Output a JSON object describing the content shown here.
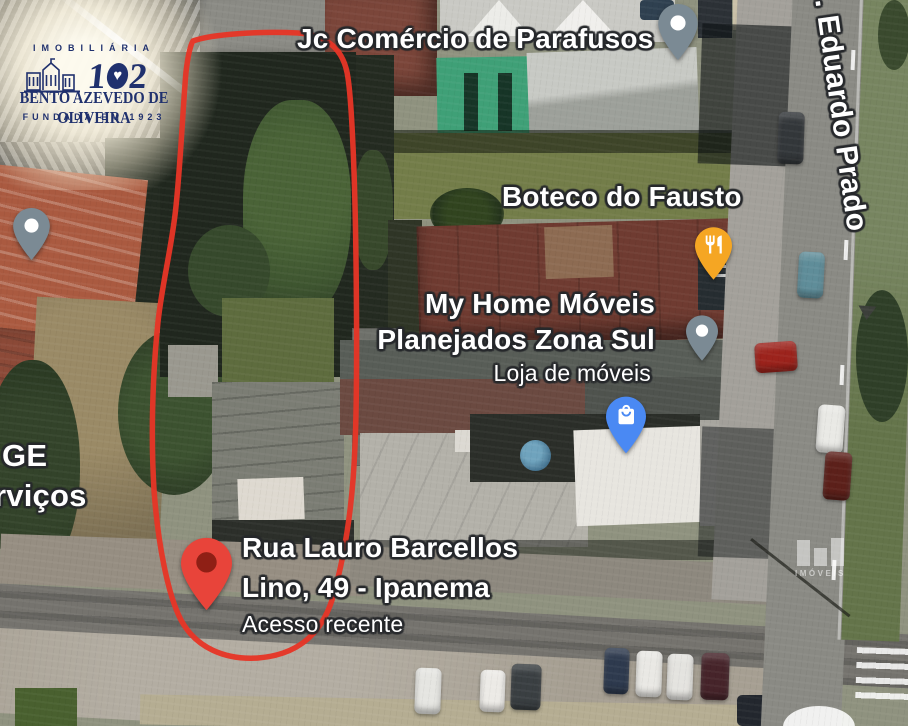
{
  "map": {
    "poi_labels": {
      "jc": "Jc Comércio de Parafusos",
      "boteco": "Boteco do Fausto",
      "myhome_line1": "My Home Móveis",
      "myhome_line2": "Planejados Zona Sul",
      "myhome_sub": "Loja de móveis",
      "partial_line1": "GE",
      "partial_line2": "rviços"
    },
    "street_label": ". Eduardo Prado",
    "selected_place": {
      "line1": "Rua Lauro Barcellos",
      "line2": "Lino, 49 - Ipanema",
      "sub": "Acesso recente"
    },
    "colors": {
      "parcel_outline": "#e63527",
      "red_pin": "#e8443a",
      "red_pin_dot": "#8f1f15",
      "gray_pin": "#7b8a94",
      "orange_pin": "#f5a623",
      "blue_pin": "#4a89f3"
    }
  },
  "logo": {
    "category": "IMOBILIÁRIA",
    "number_left": "1",
    "heart": "♥",
    "number_right": "2",
    "name": "BENTO AZEVEDO DE OLIVEIRA",
    "founded": "FUNDADA EM 1923",
    "brand_color": "#20316e"
  },
  "watermark": {
    "text": "IMÓVEIS"
  }
}
